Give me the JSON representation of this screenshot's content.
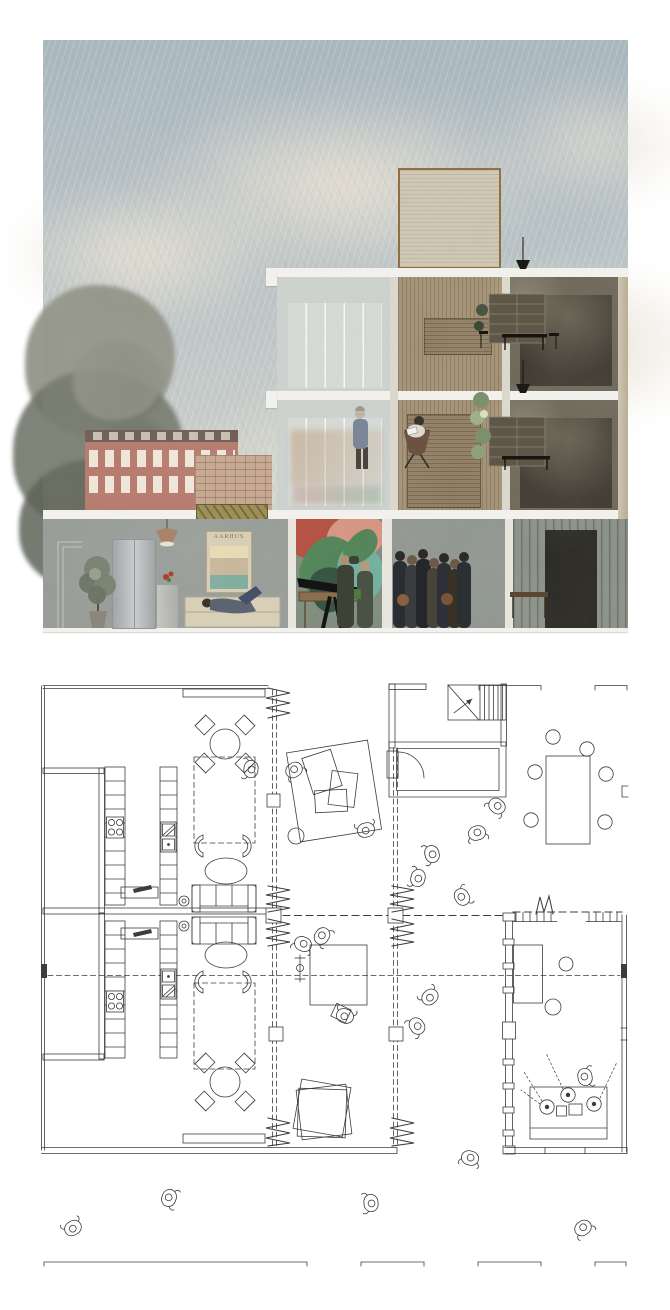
{
  "board": {
    "type": "architecture-presentation",
    "panels": [
      {
        "id": "section",
        "label": "sectional perspective rendering"
      },
      {
        "id": "plan",
        "label": "ground floor plan"
      }
    ]
  },
  "section": {
    "poster": {
      "text": "AARHUS"
    },
    "context": [
      "rain-streaked sky",
      "clouds",
      "tree",
      "brick perimeter block"
    ],
    "levels": [
      "roof volume",
      "upper studio level",
      "lower studio level",
      "ground floor commons"
    ],
    "rooms": [
      "glazed atrium",
      "timber workshop",
      "dark dining room",
      "shared kitchen lounge",
      "mural atelier",
      "gathering hall",
      "concrete anteroom"
    ]
  },
  "plan": {
    "spaces": [
      "dwelling unit north",
      "dwelling unit south",
      "shared terrace",
      "entry vestibule",
      "stair",
      "flex workshop hall",
      "music studio"
    ],
    "furniture": [
      "kitchen counters",
      "round dining tables",
      "lounge chairs",
      "sofas",
      "rugs",
      "project tables",
      "long counter with stools",
      "dj desk with turntables"
    ]
  },
  "theme": {
    "colors": {
      "paper": "#ffffff",
      "ink": "#3c3c3c",
      "skyTop": "#a7b6be",
      "skyMid": "#bcc5c7",
      "skyLow": "#cfd2ca",
      "cloud": "#e6dfd2",
      "slab": "#f4f3ef",
      "pier": "#dbd8cd",
      "glassFrame": "#cdd2cf",
      "glass": "#d6dad6",
      "wood": "#a29073",
      "woodPanel": "#8f7d62",
      "darkFrame": "#6c6658",
      "darkRoom": "#3c382f",
      "shelf": "#5e5748",
      "shelfLine": "#8c8472",
      "wallGrey": "#8f9590",
      "pierLight": "#e9e7e0",
      "muralBase": "#7d8a7a",
      "muralGreen": "#4e8255",
      "muralTeal": "#6fae9c",
      "muralDark": "#2e4f3a",
      "muralRed": "#b34a3e",
      "muralPink": "#d69480",
      "rightWall": "#8a9087",
      "doorway": "#26251f",
      "brick": "#b5786a",
      "brickRoof": "#6d5a52",
      "brickWing": "#c7a68e",
      "winFrame": "#f0e8da",
      "gold": "#9c8c50",
      "goldDark": "#5f5530",
      "roofboxBg": "#cfc7b4",
      "roofboxFrame": "#8a6a38",
      "treeA": "#8e9083",
      "treeB": "#72766a",
      "treeC": "#5f6459",
      "fridgeA": "#9fa3a4",
      "fridgeB": "#c9cccd",
      "posterBg": "#d8cfb6",
      "posterInk": "#7a6a4a",
      "water": "#7fae9e",
      "copper": "#a8846a"
    }
  }
}
